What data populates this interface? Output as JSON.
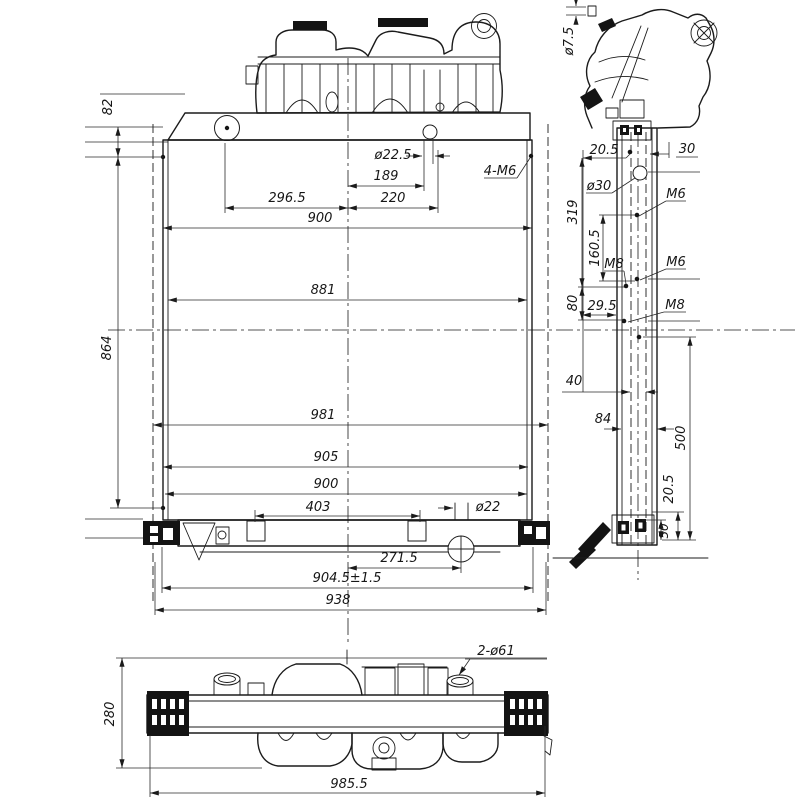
{
  "colors": {
    "background": "#ffffff",
    "line": "#1b1b1b",
    "text": "#161616"
  },
  "views": {
    "front": {
      "title": "front-view",
      "dims": {
        "d82": "82",
        "dphi225": "ø22.5",
        "d189": "189",
        "d2965": "296.5",
        "d220": "220",
        "d4m6": "4-M6",
        "d900top": "900",
        "d881": "881",
        "d864": "864",
        "d981": "981",
        "d905": "905",
        "d900bot": "900",
        "d403": "403",
        "dphi22": "ø22",
        "d2715": "271.5",
        "d9045": "904.5±1.5",
        "d938": "938"
      }
    },
    "side": {
      "title": "side-view",
      "dims": {
        "dphi75": "ø7.5",
        "d205top": "20.5",
        "d30": "30",
        "dphi30": "ø30",
        "d319": "319",
        "m6a": "M6",
        "d1605": "160.5",
        "m8a": "M8",
        "m6b": "M6",
        "d80": "80",
        "d295": "29.5",
        "m8b": "M8",
        "d40": "40",
        "d84": "84",
        "d500": "500",
        "d205bot": "20.5",
        "d50": "50"
      }
    },
    "bottom": {
      "title": "bottom-view",
      "dims": {
        "d2phi61": "2-ø61",
        "d280": "280",
        "d9855": "985.5"
      }
    }
  }
}
